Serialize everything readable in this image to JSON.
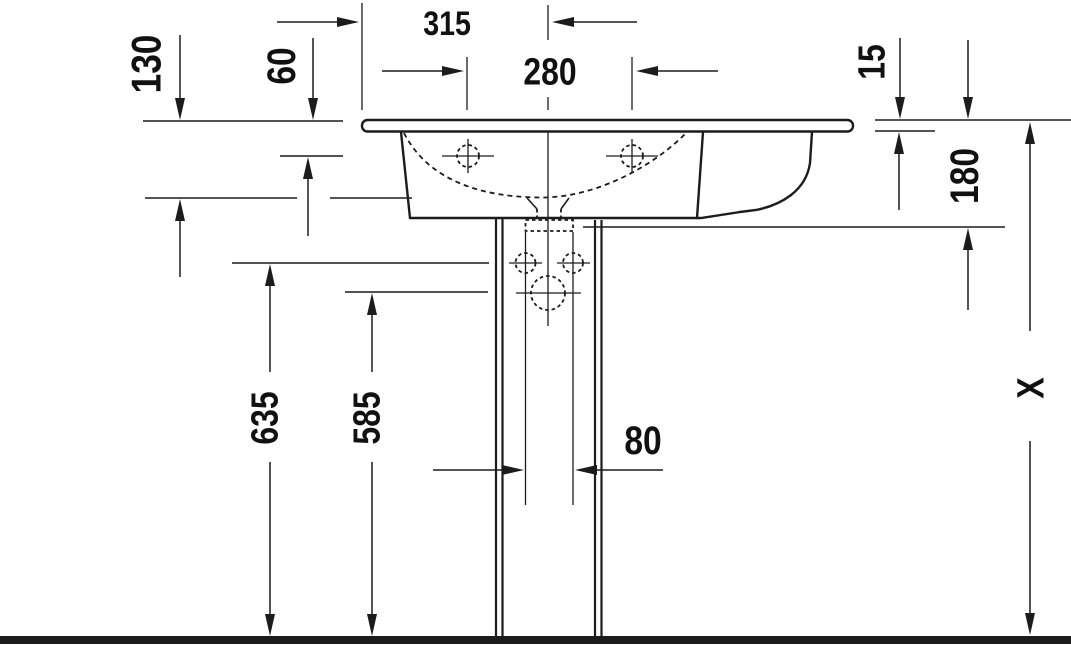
{
  "drawing": {
    "type": "technical-dimension-drawing",
    "subject": "pedestal washbasin, front elevation with dimension lines",
    "colors": {
      "ink": "#1c1c1c",
      "background": "#ffffff"
    },
    "dimensions": {
      "width_left_to_center": "315",
      "faucet_hole_spacing": "280",
      "bowl_depth": "130",
      "rim_to_faucet_deck": "60",
      "rim_thickness": "15",
      "basin_height": "180",
      "fixing_holes_height": "635",
      "siphon_height": "585",
      "pedestal_channel_width": "80",
      "total_height": "X"
    }
  }
}
